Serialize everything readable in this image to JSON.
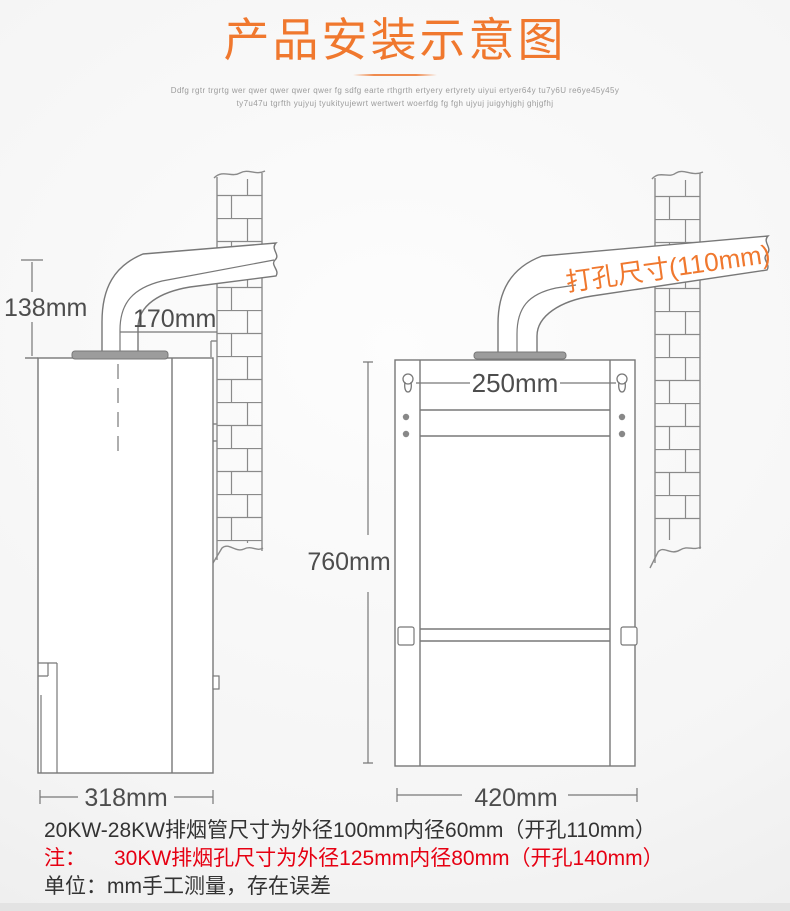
{
  "header": {
    "title": "产品安装示意图",
    "tagline1": "Ddfg rgtr trgrtg wer qwer qwer qwer qwer fg sdfg earte rthgrth ertyery ertyrety uiyui ertyer64y tu7y6U re6ye45y45y",
    "tagline2": "ty7u47u tgrfth yujyuj tyukityujewrt wertwert woerfdg fg fgh ujyuj juigyhjghj ghjgfhj"
  },
  "side_view": {
    "pipe_height": "138mm",
    "pipe_run": "170mm",
    "body_depth": "318mm"
  },
  "front_view": {
    "drill_label": "打孔尺寸(110mm)",
    "hole_spacing": "250mm",
    "body_height": "760mm",
    "body_width": "420mm"
  },
  "notes": {
    "spec_20_28": "20KW-28KW排烟管尺寸为外径100mm内径60mm（开孔110mm）",
    "note_label": "注：",
    "spec_30": "30KW排烟孔尺寸为外径125mm内径80mm（开孔140mm）",
    "unit_note": "单位：mm手工测量，存在误差"
  },
  "colors": {
    "accent_orange": "#f0782e",
    "line_gray": "#787878",
    "text_dark": "#333333",
    "alert_red": "#e60012"
  }
}
